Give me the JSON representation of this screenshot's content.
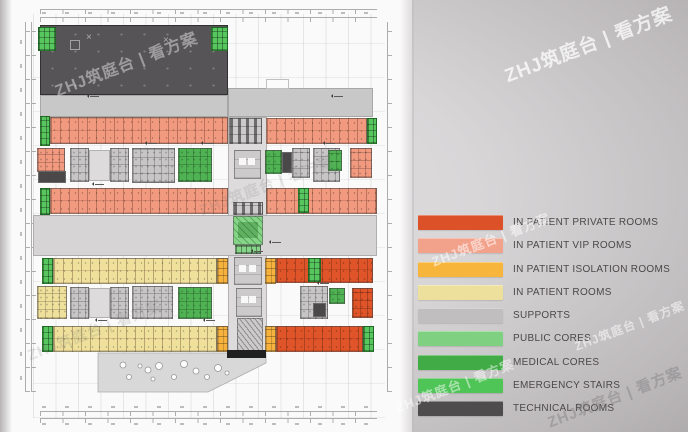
{
  "watermark": {
    "text": "ZHJ筑庭台 | 看方案"
  },
  "palette": {
    "technical": "#575457",
    "supports_strip": "#C9C8C8",
    "supports_band": "#D6D4D5",
    "supports_room": "#C7C5C6",
    "open": "#DDDBDC",
    "vip": "#F29A7F",
    "private": "#DF5428",
    "isolation": "#F6B23C",
    "rooms": "#EFE19C",
    "medical": "#4FB353",
    "public": "#86D488",
    "emergency": "#58C65E",
    "dark": "#4B4849",
    "core": "#CCCACB",
    "white": "#FBFBFB",
    "black": "#202020"
  },
  "legend": {
    "items": [
      {
        "key": "private",
        "label": "IN PATIENT PRIVATE ROOMS",
        "color": "#DD5128"
      },
      {
        "key": "vip",
        "label": "IN PATIENT VIP ROOMS",
        "color": "#F2A18A"
      },
      {
        "key": "isolation",
        "label": "IN PATIENT ISOLATION ROOMS",
        "color": "#F8B53C"
      },
      {
        "key": "rooms",
        "label": "IN PATIENT ROOMS",
        "color": "#EDDF9C"
      },
      {
        "key": "supports",
        "label": "SUPPORTS",
        "color": "#C1BEC0"
      },
      {
        "key": "public",
        "label": "PUBLIC CORES",
        "color": "#7FD081"
      },
      {
        "key": "medical",
        "label": "MEDICAL CORES",
        "color": "#41AC46"
      },
      {
        "key": "emergency",
        "label": "EMERGENCY STAIRS",
        "color": "#4FC457"
      },
      {
        "key": "technical",
        "label": "TECHNICAL ROOMS",
        "color": "#4F4C4D"
      }
    ]
  },
  "plan": {
    "zones": [
      {
        "name": "technical-block",
        "type": "technical",
        "detail": "dots",
        "x": 40,
        "y": 25,
        "w": 188,
        "h": 70
      },
      {
        "name": "stair-top-left",
        "type": "emergency",
        "detail": "cells",
        "x": 38,
        "y": 27,
        "w": 18,
        "h": 24
      },
      {
        "name": "stair-top-right",
        "type": "emergency",
        "detail": "cells",
        "x": 211,
        "y": 27,
        "w": 17,
        "h": 24
      },
      {
        "name": "supports-strip-west",
        "type": "supports_strip",
        "detail": "plain",
        "x": 40,
        "y": 95,
        "w": 188,
        "h": 22
      },
      {
        "name": "supports-strip-east",
        "type": "supports_strip",
        "detail": "plain",
        "x": 228,
        "y": 88,
        "w": 145,
        "h": 29
      },
      {
        "name": "roof-notch",
        "type": "white",
        "detail": "plain",
        "x": 266,
        "y": 79,
        "w": 23,
        "h": 10
      },
      {
        "name": "central-spine",
        "type": "open",
        "detail": "plain",
        "x": 228,
        "y": 117,
        "w": 39,
        "h": 234
      },
      {
        "name": "stair-west-a",
        "type": "emergency",
        "detail": "cells",
        "x": 40,
        "y": 116,
        "w": 10,
        "h": 30
      },
      {
        "name": "vip-row-nw",
        "type": "vip",
        "detail": "rooms",
        "x": 50,
        "y": 117,
        "w": 178,
        "h": 27
      },
      {
        "name": "elevator-core-north",
        "type": "core",
        "detail": "lift",
        "x": 229,
        "y": 118,
        "w": 33,
        "h": 26
      },
      {
        "name": "vip-row-ne",
        "type": "vip",
        "detail": "rooms",
        "x": 266,
        "y": 118,
        "w": 101,
        "h": 26
      },
      {
        "name": "stair-east-a",
        "type": "emergency",
        "detail": "cells",
        "x": 367,
        "y": 118,
        "w": 10,
        "h": 26
      },
      {
        "name": "vip-block-west",
        "type": "vip",
        "detail": "busy",
        "x": 37,
        "y": 148,
        "w": 28,
        "h": 24
      },
      {
        "name": "dark-room-west",
        "type": "dark",
        "detail": "plain",
        "x": 38,
        "y": 171,
        "w": 28,
        "h": 12
      },
      {
        "name": "support-rooms-a",
        "type": "supports_room",
        "detail": "busy",
        "x": 70,
        "y": 148,
        "w": 19,
        "h": 34
      },
      {
        "name": "corridor-a",
        "type": "open",
        "detail": "plain",
        "x": 89,
        "y": 150,
        "w": 21,
        "h": 31
      },
      {
        "name": "support-rooms-b",
        "type": "supports_room",
        "detail": "busy",
        "x": 110,
        "y": 148,
        "w": 19,
        "h": 34
      },
      {
        "name": "support-rooms-c",
        "type": "supports_room",
        "detail": "busy",
        "x": 132,
        "y": 148,
        "w": 43,
        "h": 35
      },
      {
        "name": "medical-core-nw",
        "type": "medical",
        "detail": "busy",
        "x": 178,
        "y": 148,
        "w": 34,
        "h": 34
      },
      {
        "name": "core-hall-north",
        "type": "core",
        "detail": "squares",
        "x": 234,
        "y": 150,
        "w": 27,
        "h": 29
      },
      {
        "name": "medical-core-ne1",
        "type": "medical",
        "detail": "busy",
        "x": 265,
        "y": 150,
        "w": 17,
        "h": 24
      },
      {
        "name": "dark-room-east",
        "type": "dark",
        "detail": "plain",
        "x": 282,
        "y": 152,
        "w": 10,
        "h": 21
      },
      {
        "name": "support-rooms-d",
        "type": "supports_room",
        "detail": "busy",
        "x": 292,
        "y": 148,
        "w": 18,
        "h": 30
      },
      {
        "name": "support-rooms-e",
        "type": "supports_room",
        "detail": "busy",
        "x": 313,
        "y": 148,
        "w": 27,
        "h": 34
      },
      {
        "name": "medical-core-ne2",
        "type": "medical",
        "detail": "busy",
        "x": 328,
        "y": 150,
        "w": 14,
        "h": 21
      },
      {
        "name": "vip-block-east",
        "type": "vip",
        "detail": "busy",
        "x": 350,
        "y": 148,
        "w": 22,
        "h": 30
      },
      {
        "name": "stair-west-b",
        "type": "emergency",
        "detail": "cells",
        "x": 40,
        "y": 188,
        "w": 10,
        "h": 27
      },
      {
        "name": "vip-row-sw",
        "type": "vip",
        "detail": "rooms",
        "x": 50,
        "y": 188,
        "w": 178,
        "h": 26
      },
      {
        "name": "vip-row-se",
        "type": "vip",
        "detail": "rooms",
        "x": 266,
        "y": 188,
        "w": 111,
        "h": 26
      },
      {
        "name": "stair-mid-east",
        "type": "emergency",
        "detail": "cells",
        "x": 298,
        "y": 188,
        "w": 11,
        "h": 25
      },
      {
        "name": "supports-band",
        "type": "supports_band",
        "detail": "plain",
        "x": 33,
        "y": 215,
        "w": 344,
        "h": 41
      },
      {
        "name": "elevator-bank-upper",
        "type": "core",
        "detail": "lift",
        "x": 233,
        "y": 202,
        "w": 30,
        "h": 13
      },
      {
        "name": "public-core",
        "type": "public",
        "detail": "publichatch",
        "x": 233,
        "y": 216,
        "w": 30,
        "h": 29
      },
      {
        "name": "public-core-cells",
        "type": "public",
        "detail": "cells",
        "x": 235,
        "y": 245,
        "w": 26,
        "h": 9
      },
      {
        "name": "stair-west-c",
        "type": "emergency",
        "detail": "cells",
        "x": 42,
        "y": 258,
        "w": 11,
        "h": 26
      },
      {
        "name": "patient-rooms-row1",
        "type": "rooms",
        "detail": "rooms",
        "x": 53,
        "y": 258,
        "w": 164,
        "h": 26
      },
      {
        "name": "isolation-west-a",
        "type": "isolation",
        "detail": "rooms2",
        "x": 217,
        "y": 258,
        "w": 11,
        "h": 26
      },
      {
        "name": "elevator-lobby",
        "type": "core",
        "detail": "squares",
        "x": 234,
        "y": 257,
        "w": 28,
        "h": 28
      },
      {
        "name": "isolation-east-a",
        "type": "isolation",
        "detail": "rooms2",
        "x": 265,
        "y": 258,
        "w": 11,
        "h": 26
      },
      {
        "name": "private-rooms-row1",
        "type": "private",
        "detail": "rooms",
        "x": 276,
        "y": 258,
        "w": 97,
        "h": 25
      },
      {
        "name": "stair-east-b",
        "type": "emergency",
        "detail": "cells",
        "x": 308,
        "y": 258,
        "w": 13,
        "h": 24
      },
      {
        "name": "rooms-block-west",
        "type": "rooms",
        "detail": "busy",
        "x": 37,
        "y": 286,
        "w": 30,
        "h": 33
      },
      {
        "name": "support-rooms-f",
        "type": "supports_room",
        "detail": "busy",
        "x": 70,
        "y": 287,
        "w": 19,
        "h": 32
      },
      {
        "name": "corridor-b",
        "type": "open",
        "detail": "plain",
        "x": 89,
        "y": 288,
        "w": 21,
        "h": 30
      },
      {
        "name": "support-rooms-g",
        "type": "supports_room",
        "detail": "busy",
        "x": 110,
        "y": 287,
        "w": 19,
        "h": 32
      },
      {
        "name": "support-rooms-h",
        "type": "supports_room",
        "detail": "busy",
        "x": 132,
        "y": 286,
        "w": 41,
        "h": 33
      },
      {
        "name": "medical-core-sw",
        "type": "medical",
        "detail": "busy",
        "x": 178,
        "y": 287,
        "w": 34,
        "h": 32
      },
      {
        "name": "core-hall-south",
        "type": "core",
        "detail": "squares",
        "x": 236,
        "y": 288,
        "w": 26,
        "h": 29
      },
      {
        "name": "support-rooms-i",
        "type": "supports_room",
        "detail": "busy",
        "x": 300,
        "y": 286,
        "w": 28,
        "h": 33
      },
      {
        "name": "dark-room-south",
        "type": "dark",
        "detail": "plain",
        "x": 313,
        "y": 303,
        "w": 13,
        "h": 14
      },
      {
        "name": "medical-core-se",
        "type": "medical",
        "detail": "busy",
        "x": 329,
        "y": 288,
        "w": 16,
        "h": 16
      },
      {
        "name": "private-block-east",
        "type": "private",
        "detail": "busy",
        "x": 352,
        "y": 288,
        "w": 21,
        "h": 30
      },
      {
        "name": "stair-west-d",
        "type": "emergency",
        "detail": "cells",
        "x": 42,
        "y": 326,
        "w": 11,
        "h": 26
      },
      {
        "name": "patient-rooms-row2",
        "type": "rooms",
        "detail": "rooms",
        "x": 53,
        "y": 326,
        "w": 164,
        "h": 26
      },
      {
        "name": "isolation-west-b",
        "type": "isolation",
        "detail": "rooms2",
        "x": 217,
        "y": 326,
        "w": 11,
        "h": 26
      },
      {
        "name": "escalator-core",
        "type": "core",
        "detail": "hatch",
        "x": 237,
        "y": 318,
        "w": 26,
        "h": 33
      },
      {
        "name": "isolation-east-b",
        "type": "isolation",
        "detail": "rooms2",
        "x": 265,
        "y": 326,
        "w": 11,
        "h": 26
      },
      {
        "name": "private-rooms-row2",
        "type": "private",
        "detail": "rooms",
        "x": 276,
        "y": 326,
        "w": 87,
        "h": 26
      },
      {
        "name": "stair-east-c",
        "type": "emergency",
        "detail": "cells",
        "x": 363,
        "y": 326,
        "w": 11,
        "h": 26
      },
      {
        "name": "entry-bar",
        "type": "black",
        "detail": "plain",
        "x": 227,
        "y": 350,
        "w": 39,
        "h": 8
      }
    ]
  }
}
